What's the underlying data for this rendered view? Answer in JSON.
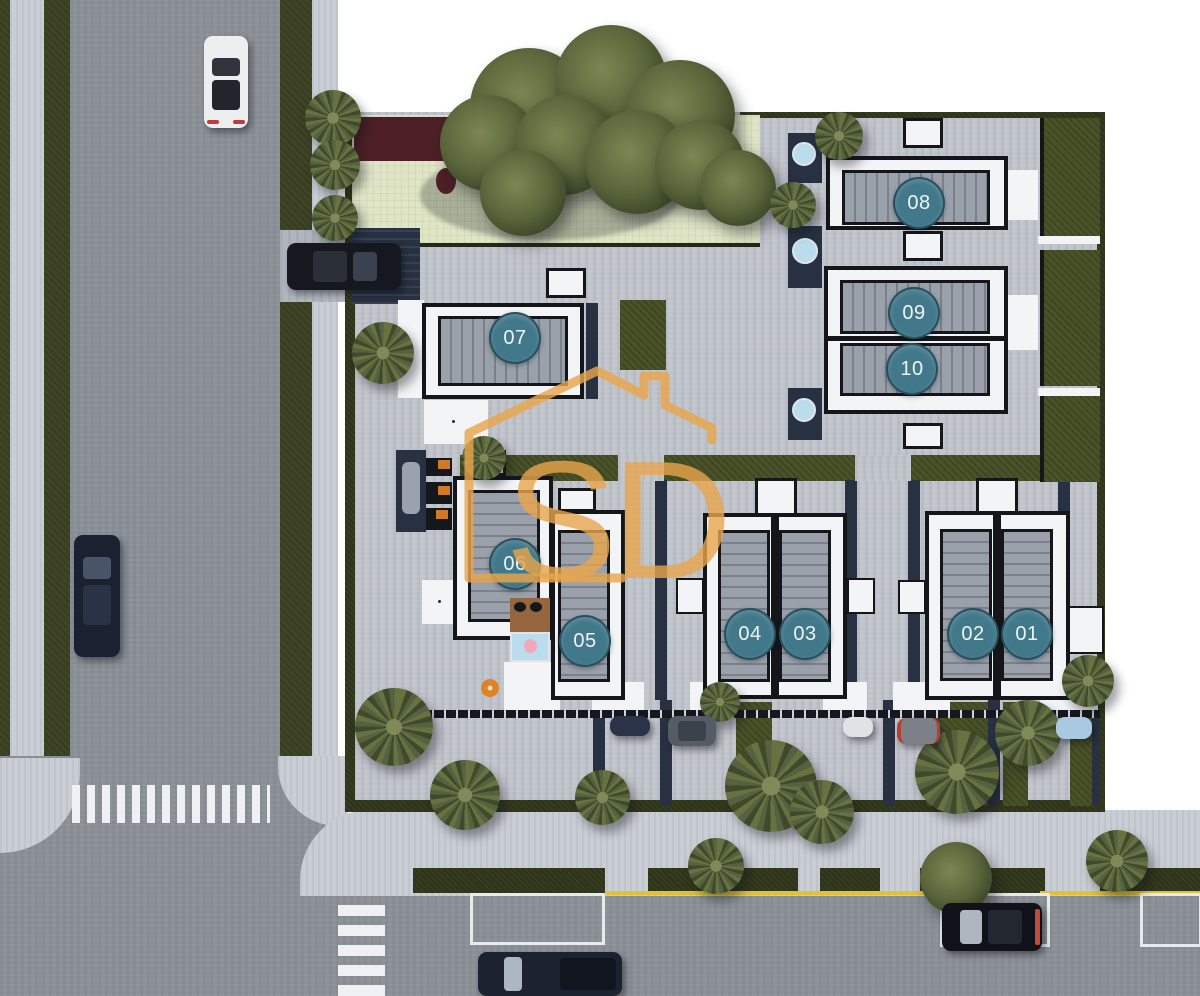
{
  "plan": {
    "description": "Top-view 3D rendered site plan of a residential development with ten numbered villas, courtyards, garden, pools, perimeter roads, crosswalks, parked cars and palm trees.",
    "unit_count": 10
  },
  "watermark": {
    "letters": "SD"
  },
  "units": [
    {
      "label": "01"
    },
    {
      "label": "02"
    },
    {
      "label": "03"
    },
    {
      "label": "04"
    },
    {
      "label": "05"
    },
    {
      "label": "06"
    },
    {
      "label": "07"
    },
    {
      "label": "08"
    },
    {
      "label": "09"
    },
    {
      "label": "10"
    }
  ],
  "colors": {
    "badge_teal": "#41788a",
    "watermark_gold": "#e9a64d",
    "asphalt": "#8b9097",
    "paver": "#c0c4cb",
    "sidewalk": "#c9cdd4",
    "grass": "#3f4425",
    "garden_lawn": "#e0e5c6",
    "roof_gray": "#9aa1ab",
    "building_white": "#f3f4f6",
    "outline_black": "#14161a",
    "pool_blue": "#badced",
    "float_pink": "#f0a9bb",
    "yellow_curb_line": "#e2c137"
  }
}
